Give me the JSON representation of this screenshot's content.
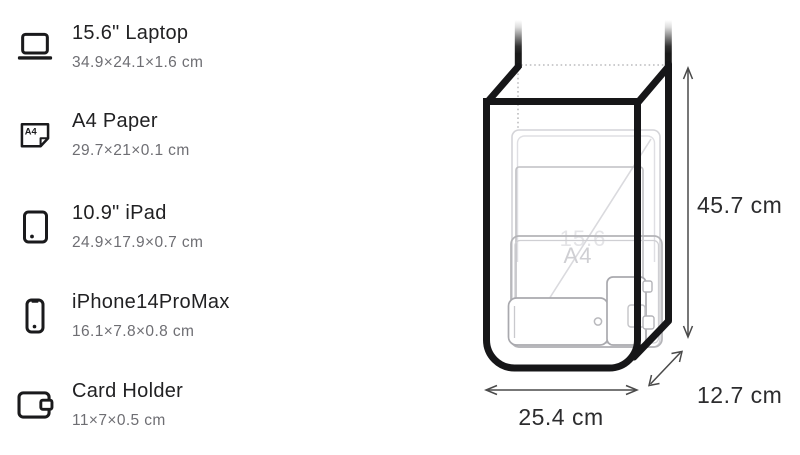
{
  "items": [
    {
      "icon": "laptop-icon",
      "name": "15.6\" Laptop",
      "dimensions": "34.9×24.1×1.6 cm"
    },
    {
      "icon": "a4-paper-icon",
      "name": "A4 Paper",
      "dimensions": "29.7×21×0.1 cm",
      "icon_label": "A4"
    },
    {
      "icon": "ipad-icon",
      "name": "10.9\" iPad",
      "dimensions": "24.9×17.9×0.7 cm"
    },
    {
      "icon": "iphone-icon",
      "name": "iPhone14ProMax",
      "dimensions": "16.1×7.8×0.8 cm"
    },
    {
      "icon": "card-holder-icon",
      "name": "Card Holder",
      "dimensions": "11×7×0.5 cm"
    }
  ],
  "bag_diagram": {
    "height_label": "45.7 cm",
    "width_label": "25.4 cm",
    "depth_label": "12.7 cm",
    "watermark_laptop": "15.6",
    "watermark_a4": "A4",
    "colors": {
      "bag_outline": "#161618",
      "item_outline": "#b4b4b8",
      "dimension_line": "#4a4a4a",
      "dimension_text": "#2c2c2e"
    }
  }
}
